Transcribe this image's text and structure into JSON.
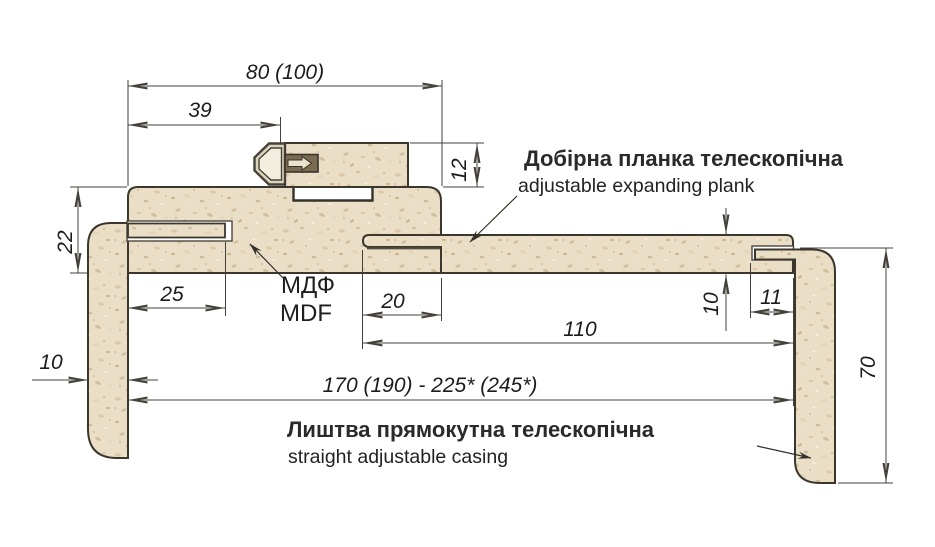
{
  "drawing": {
    "kind": "door-frame-casing-cross-section",
    "labels": {
      "plank_title_uk": "Добірна планка телескопічна",
      "plank_subtitle_en": "adjustable expanding plank",
      "casing_title_uk": "Лиштва прямокутна телескопічна",
      "casing_subtitle_en": "straight adjustable casing",
      "material_uk": "МДФ",
      "material_en": "MDF"
    },
    "dimensions": {
      "frame_total_width": "80 (100)",
      "tenon_offset": "39",
      "jamb_stop_height": "12",
      "frame_thickness": "22",
      "casing_tongue_depth": "25",
      "plank_tongue_depth": "20",
      "plank_width": "110",
      "plank_thickness": "10",
      "right_tongue_depth": "11",
      "casing_thickness": "10",
      "casing_width": "70",
      "overall_range": "170 (190) - 225* (245*)"
    },
    "colors": {
      "background": "#ffffff",
      "mdf_base": "#eadec7",
      "outline": "#3b372d",
      "dim_line": "#44403a",
      "connector_dark": "#7b6c51",
      "connector_light": "#f3efdf",
      "text": "#1c1c1c"
    }
  }
}
